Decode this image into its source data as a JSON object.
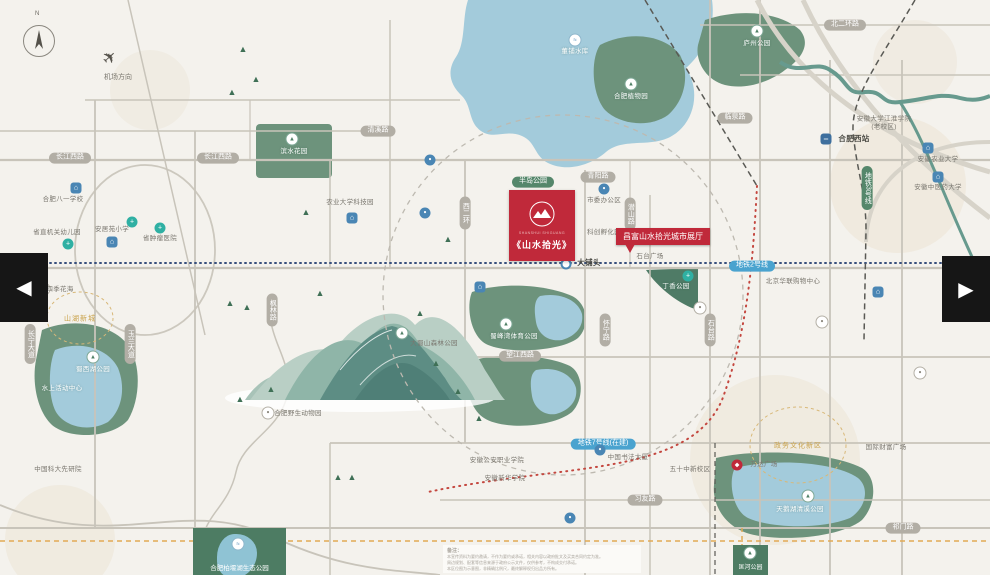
{
  "colors": {
    "accent_red": "#c0293a",
    "park_green": "#6d937c",
    "water_blue": "#a3cbdb",
    "road_pill": "#b2aea5",
    "metro_green": "#55876b",
    "metro_blue": "#4aa3cf",
    "gold": "#c9a24a"
  },
  "branding": {
    "pinyin": "SHANSHUI SHIGUANG",
    "name": "《山水拾光》",
    "logo_icon": "mountain-in-circle"
  },
  "callout": {
    "text": "昌富山水拾光城市展厅"
  },
  "compass": {
    "north": "N",
    "icon": "compass-needle"
  },
  "airport": {
    "label": "机场方向",
    "icon": "airplane"
  },
  "carousel": {
    "prev": "◀",
    "next": "▶"
  },
  "banner": {
    "label": "合肥柏堰湖生态公园"
  },
  "strip": {
    "label": "匡河公园"
  },
  "disclaimer": {
    "heading": "备注：",
    "lines": [
      "本宣传资料为要约邀请，不作为要约或承诺，相关内容以政府批文及买卖合同约定为准。",
      "周边规划、配套等信息来源于政府公示文件，仅供参考，不构成交付承诺。",
      "本区位图为示意图，非精确比例尺，最终解释权归出品方所有。"
    ]
  },
  "road_pills": [
    {
      "t": "长江西路",
      "x": 70,
      "y": 158
    },
    {
      "t": "长江西路",
      "x": 218,
      "y": 158
    },
    {
      "t": "清溪路",
      "x": 378,
      "y": 131
    },
    {
      "t": "青阳路",
      "x": 598,
      "y": 177
    },
    {
      "t": "北二环路",
      "x": 845,
      "y": 25
    },
    {
      "t": "临泉路",
      "x": 735,
      "y": 118
    },
    {
      "t": "望江西路",
      "x": 520,
      "y": 356
    },
    {
      "t": "习友路",
      "x": 645,
      "y": 500
    },
    {
      "t": "祁门路",
      "x": 903,
      "y": 528
    },
    {
      "t": "西二环",
      "x": 465,
      "y": 213,
      "v": 1
    },
    {
      "t": "潜山路",
      "x": 630,
      "y": 214,
      "v": 1
    },
    {
      "t": "怀宁路",
      "x": 605,
      "y": 330,
      "v": 1
    },
    {
      "t": "石台路",
      "x": 710,
      "y": 330,
      "v": 1
    },
    {
      "t": "长宁大道",
      "x": 30,
      "y": 344,
      "v": 1
    },
    {
      "t": "玉兰大道",
      "x": 130,
      "y": 344,
      "v": 1
    },
    {
      "t": "枫林路",
      "x": 272,
      "y": 310,
      "v": 1
    },
    {
      "t": "地铁3号线",
      "x": 867,
      "y": 188,
      "v": 1,
      "kind": "green"
    },
    {
      "t": "地铁2号线",
      "x": 752,
      "y": 266,
      "kind": "blue"
    },
    {
      "t": "地铁7号线(在建)",
      "x": 603,
      "y": 444,
      "kind": "blue"
    },
    {
      "t": "半岛公园",
      "x": 533,
      "y": 182,
      "kind": "green"
    }
  ],
  "labels": [
    {
      "t": "董铺水库",
      "x": 575,
      "y": 52,
      "c": "w"
    },
    {
      "t": "合肥植物园",
      "x": 631,
      "y": 97,
      "c": "w"
    },
    {
      "t": "庐州公园",
      "x": 757,
      "y": 44,
      "c": "w"
    },
    {
      "t": "合肥八一学校",
      "x": 63,
      "y": 200,
      "c": "g"
    },
    {
      "t": "省直机关幼儿园",
      "x": 57,
      "y": 233,
      "c": "g"
    },
    {
      "t": "安居苑小学",
      "x": 112,
      "y": 230,
      "c": "g"
    },
    {
      "t": "省肿瘤医院",
      "x": 160,
      "y": 239,
      "c": "g"
    },
    {
      "t": "四季花海",
      "x": 60,
      "y": 290,
      "c": "g"
    },
    {
      "t": "中国科大先研院",
      "x": 58,
      "y": 470,
      "c": "g"
    },
    {
      "t": "安徽公安职业学院",
      "x": 497,
      "y": 461,
      "c": "g"
    },
    {
      "t": "安徽新华学院",
      "x": 505,
      "y": 479,
      "c": "g"
    },
    {
      "t": "农业大学科技园",
      "x": 350,
      "y": 203,
      "c": "g"
    },
    {
      "t": "滨水花园",
      "x": 294,
      "y": 152,
      "c": "w"
    },
    {
      "t": "市委办公区",
      "x": 604,
      "y": 201,
      "c": "g"
    },
    {
      "t": "科创孵化园",
      "x": 604,
      "y": 233,
      "c": "g"
    },
    {
      "t": "石台广场",
      "x": 650,
      "y": 257,
      "c": "g"
    },
    {
      "t": "丁香公园",
      "x": 676,
      "y": 287,
      "c": "w"
    },
    {
      "t": "北京华联购物中心",
      "x": 793,
      "y": 282,
      "c": "g"
    },
    {
      "t": "安徽大学江淮学院\n(老校区)",
      "x": 884,
      "y": 124,
      "c": "g"
    },
    {
      "t": "安徽农业大学",
      "x": 938,
      "y": 160,
      "c": "g"
    },
    {
      "t": "安徽中医药大学",
      "x": 938,
      "y": 188,
      "c": "g"
    },
    {
      "t": "万达广场",
      "x": 764,
      "y": 465,
      "c": "g"
    },
    {
      "t": "国际财富广场",
      "x": 886,
      "y": 448,
      "c": "g"
    },
    {
      "t": "中国书法大厦",
      "x": 628,
      "y": 458,
      "c": "g"
    },
    {
      "t": "五十中新校区",
      "x": 690,
      "y": 470,
      "c": "g"
    },
    {
      "t": "大铺头",
      "x": 589,
      "y": 263,
      "c": "d"
    },
    {
      "t": "大蜀山森林公园",
      "x": 434,
      "y": 344,
      "c": "g"
    },
    {
      "t": "合肥野生动物园",
      "x": 298,
      "y": 414,
      "c": "g"
    },
    {
      "t": "蜀峰湾体育公园",
      "x": 514,
      "y": 337,
      "c": "w"
    },
    {
      "t": "蜀西湖公园",
      "x": 93,
      "y": 370,
      "c": "w"
    },
    {
      "t": "水上活动中心",
      "x": 62,
      "y": 389,
      "c": "w"
    },
    {
      "t": "天鹅湖清溪公园",
      "x": 800,
      "y": 510,
      "c": "w"
    },
    {
      "t": "山湖新城",
      "x": 80,
      "y": 319,
      "c": "gd"
    },
    {
      "t": "政务文化新区",
      "x": 798,
      "y": 446,
      "c": "gd"
    },
    {
      "t": "合肥西站",
      "x": 854,
      "y": 139,
      "c": "d"
    }
  ],
  "poi_icons": [
    {
      "x": 575,
      "y": 40,
      "k": "water"
    },
    {
      "x": 631,
      "y": 84,
      "k": "tree"
    },
    {
      "x": 757,
      "y": 31,
      "k": "tree"
    },
    {
      "x": 76,
      "y": 188,
      "k": "school"
    },
    {
      "x": 68,
      "y": 244,
      "k": "hospital"
    },
    {
      "x": 112,
      "y": 242,
      "k": "school"
    },
    {
      "x": 160,
      "y": 228,
      "k": "hospital"
    },
    {
      "x": 132,
      "y": 222,
      "k": "hospital"
    },
    {
      "x": 44,
      "y": 289,
      "k": "generic"
    },
    {
      "x": 604,
      "y": 189,
      "k": "transit"
    },
    {
      "x": 688,
      "y": 276,
      "k": "hospital"
    },
    {
      "x": 928,
      "y": 148,
      "k": "school"
    },
    {
      "x": 938,
      "y": 177,
      "k": "school"
    },
    {
      "x": 826,
      "y": 139,
      "k": "train"
    },
    {
      "x": 737,
      "y": 465,
      "k": "red"
    },
    {
      "x": 600,
      "y": 450,
      "k": "transit"
    },
    {
      "x": 402,
      "y": 333,
      "k": "tree"
    },
    {
      "x": 268,
      "y": 413,
      "k": "generic"
    },
    {
      "x": 506,
      "y": 324,
      "k": "tree"
    },
    {
      "x": 93,
      "y": 357,
      "k": "tree"
    },
    {
      "x": 808,
      "y": 496,
      "k": "tree"
    },
    {
      "x": 566,
      "y": 264,
      "k": "station"
    },
    {
      "x": 352,
      "y": 218,
      "k": "school"
    },
    {
      "x": 430,
      "y": 160,
      "k": "transit"
    },
    {
      "x": 425,
      "y": 213,
      "k": "transit"
    },
    {
      "x": 480,
      "y": 287,
      "k": "school"
    },
    {
      "x": 700,
      "y": 308,
      "k": "generic"
    },
    {
      "x": 822,
      "y": 322,
      "k": "generic"
    },
    {
      "x": 878,
      "y": 292,
      "k": "school"
    },
    {
      "x": 920,
      "y": 373,
      "k": "generic"
    },
    {
      "x": 292,
      "y": 139,
      "k": "tree"
    },
    {
      "x": 570,
      "y": 518,
      "k": "transit"
    },
    {
      "x": 238,
      "y": 544,
      "k": "water"
    },
    {
      "x": 750,
      "y": 553,
      "k": "tree"
    }
  ]
}
